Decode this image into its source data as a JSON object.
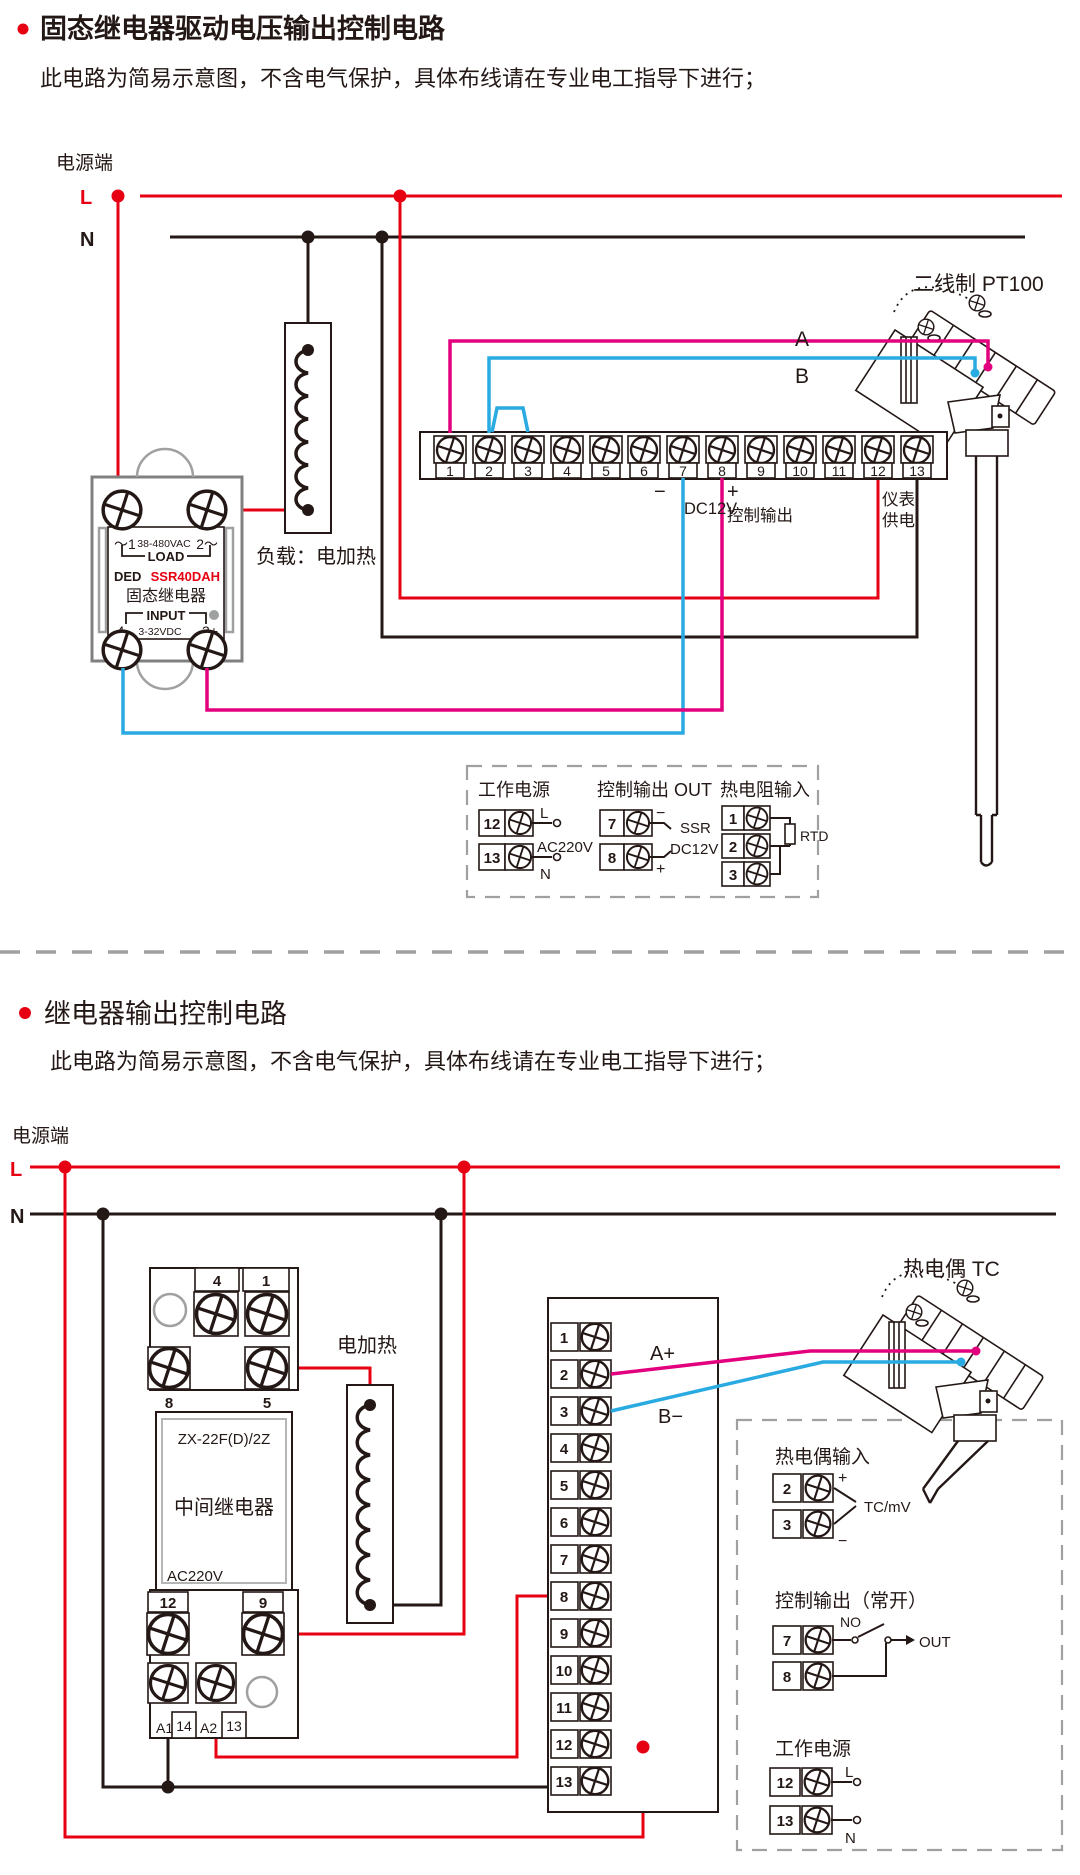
{
  "colors": {
    "accent_red": "#e60012",
    "wire_magenta": "#e3007f",
    "wire_blue": "#29abe2",
    "ink": "#231815",
    "gray": "#9fa0a0"
  },
  "section1": {
    "title": "固态继电器驱动电压输出控制电路",
    "subtitle": "此电路为简易示意图，不含电气保护，具体布线请在专业电工指导下进行；",
    "power": {
      "label": "电源端",
      "l": "L",
      "n": "N"
    },
    "ssr": {
      "pin1": "～1",
      "vac": "38-480VAC",
      "pin2": "2～",
      "load": "LOAD",
      "brand": "DED",
      "model": "SSR40DAH",
      "name": "固态继电器",
      "input": "INPUT",
      "pin4": "-4",
      "vdc": "3-32VDC",
      "pin3": "3+"
    },
    "load_label": "负载：电加热",
    "terminals": [
      "1",
      "2",
      "3",
      "4",
      "5",
      "6",
      "7",
      "8",
      "9",
      "10",
      "11",
      "12",
      "13"
    ],
    "labels": {
      "minus": "−",
      "dc12v": "DC12V",
      "plus": "+",
      "ctrl": "控制输出",
      "meter1": "仪表",
      "meter2": "供电",
      "wire_a": "A",
      "wire_b": "B"
    },
    "sensor_label": "二线制 PT100",
    "legend": {
      "power_title": "工作电源",
      "power_t1": "12",
      "power_t2": "13",
      "power_l": "L",
      "power_v": "AC220V",
      "power_n": "N",
      "out_title": "控制输出 OUT",
      "out_t1": "7",
      "out_t2": "8",
      "out_minus": "−",
      "out_plus": "+",
      "out_ssr": "SSR",
      "out_v": "DC12V",
      "rtd_title": "热电阻输入",
      "rtd_t1": "1",
      "rtd_t2": "2",
      "rtd_t3": "3",
      "rtd": "RTD"
    }
  },
  "section2": {
    "title": "继电器输出控制电路",
    "subtitle": "此电路为简易示意图，不含电气保护，具体布线请在专业电工指导下进行；",
    "power": {
      "label": "电源端",
      "l": "L",
      "n": "N"
    },
    "relay": {
      "t4": "4",
      "t1": "1",
      "t8": "8",
      "t5": "5",
      "model": "ZX-22F(D)/2Z",
      "name": "中间继电器",
      "volt": "AC220V",
      "t12": "12",
      "t9": "9",
      "a1": "A1",
      "t14": "14",
      "a2": "A2",
      "t13": "13"
    },
    "heater_label": "电加热",
    "terminals": [
      "1",
      "2",
      "3",
      "4",
      "5",
      "6",
      "7",
      "8",
      "9",
      "10",
      "11",
      "12",
      "13"
    ],
    "labels": {
      "wire_a": "A+",
      "wire_b": "B−"
    },
    "sensor_label": "热电偶 TC",
    "legend": {
      "tc_title": "热电偶输入",
      "tc_t1": "2",
      "tc_t2": "3",
      "tc_plus": "+",
      "tc_minus": "−",
      "tc": "TC/mV",
      "out_title": "控制输出（常开）",
      "out_t1": "7",
      "out_t2": "8",
      "no": "NO",
      "out": "OUT",
      "power_title": "工作电源",
      "power_t1": "12",
      "power_t2": "13",
      "power_l": "L",
      "power_n": "N"
    }
  }
}
